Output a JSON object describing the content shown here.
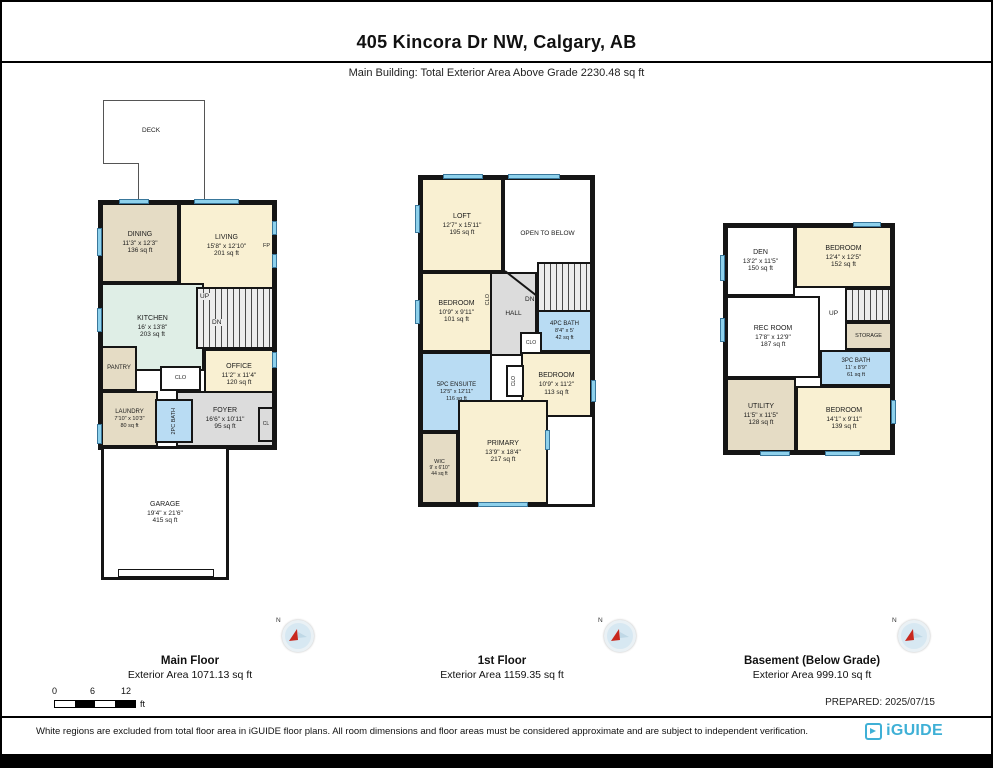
{
  "header": {
    "title": "405 Kincora Dr NW, Calgary, AB",
    "subtitle": "Main Building: Total Exterior Area Above Grade 2230.48 sq ft"
  },
  "colors": {
    "wall": "#151515",
    "room_cream": "#f9f0d2",
    "room_tan": "#e5dcc5",
    "kitchen_green": "#dfeee6",
    "bath_blue": "#b9dcf3",
    "hall_gray": "#dcdcdc",
    "window_blue": "#8ed1ec",
    "brand_blue": "#3fb0d6",
    "compass_red": "#c8281e"
  },
  "main_floor": {
    "caption": "Main Floor",
    "caption_area": "Exterior Area 1071.13 sq ft",
    "deck": {
      "name": "DECK"
    },
    "dining": {
      "name": "DINING",
      "dims": "11'3\" x 12'3\"",
      "area": "136 sq ft"
    },
    "living": {
      "name": "LIVING",
      "dims": "15'8\" x 12'10\"",
      "area": "201 sq ft"
    },
    "kitchen": {
      "name": "KITCHEN",
      "dims": "16' x 13'8\"",
      "area": "203 sq ft"
    },
    "office": {
      "name": "OFFICE",
      "dims": "11'2\" x 11'4\"",
      "area": "120 sq ft"
    },
    "pantry": {
      "name": "PANTRY"
    },
    "laundry": {
      "name": "LAUNDRY",
      "dims": "7'10\" x 10'3\"",
      "area": "80 sq ft"
    },
    "bath2": {
      "name": "2PC BATH",
      "dims": "4'8\" x 4'7\""
    },
    "foyer": {
      "name": "FOYER",
      "dims": "16'6\" x 10'11\"",
      "area": "95 sq ft"
    },
    "garage": {
      "name": "GARAGE",
      "dims": "19'4\" x 21'6\"",
      "area": "415 sq ft"
    },
    "clo": "CLO",
    "cl": "CL",
    "up": "UP",
    "dn": "DN",
    "fp": "FP"
  },
  "first_floor": {
    "caption": "1st Floor",
    "caption_area": "Exterior Area 1159.35 sq ft",
    "loft": {
      "name": "LOFT",
      "dims": "12'7\" x 15'11\"",
      "area": "195 sq ft"
    },
    "open_below": {
      "name": "OPEN TO BELOW"
    },
    "bedroom1": {
      "name": "BEDROOM",
      "dims": "10'9\" x 9'11\"",
      "area": "101 sq ft"
    },
    "hall": {
      "name": "HALL"
    },
    "bath4": {
      "name": "4PC BATH",
      "dims": "8'4\" x 5'",
      "area": "42 sq ft"
    },
    "ensuite": {
      "name": "5PC ENSUITE",
      "dims": "12'5\" x 12'11\"",
      "area": "116 sq ft"
    },
    "bedroom2": {
      "name": "BEDROOM",
      "dims": "10'9\" x 11'2\"",
      "area": "113 sq ft"
    },
    "primary": {
      "name": "PRIMARY",
      "dims": "13'9\" x 18'4\"",
      "area": "217 sq ft"
    },
    "wic": {
      "name": "WIC",
      "dims": "9' x 6'10\"",
      "area": "44 sq ft"
    },
    "dn": "DN",
    "clo": "CLO"
  },
  "basement": {
    "caption": "Basement (Below Grade)",
    "caption_area": "Exterior Area 999.10 sq ft",
    "den": {
      "name": "DEN",
      "dims": "13'2\" x 11'5\"",
      "area": "150 sq ft"
    },
    "bedroom1": {
      "name": "BEDROOM",
      "dims": "12'4\" x 12'5\"",
      "area": "152 sq ft"
    },
    "rec": {
      "name": "REC ROOM",
      "dims": "17'8\" x 12'9\"",
      "area": "187 sq ft"
    },
    "storage": {
      "name": "STORAGE"
    },
    "bath3": {
      "name": "3PC BATH",
      "dims": "11' x 8'9\"",
      "area": "61 sq ft"
    },
    "utility": {
      "name": "UTILITY",
      "dims": "11'5\" x 11'5\"",
      "area": "128 sq ft"
    },
    "bedroom2": {
      "name": "BEDROOM",
      "dims": "14'1\" x 9'11\"",
      "area": "139 sq ft"
    },
    "up": "UP"
  },
  "compass": {
    "north": "N"
  },
  "scale_bar": {
    "t0": "0",
    "t6": "6",
    "t12": "12",
    "unit": "ft"
  },
  "prepared": "PREPARED: 2025/07/15",
  "footer": {
    "disclaimer": "White regions are excluded from total floor area in iGUIDE floor plans. All room dimensions and floor areas must be considered approximate and are subject to independent verification.",
    "brand": "iGUIDE"
  }
}
